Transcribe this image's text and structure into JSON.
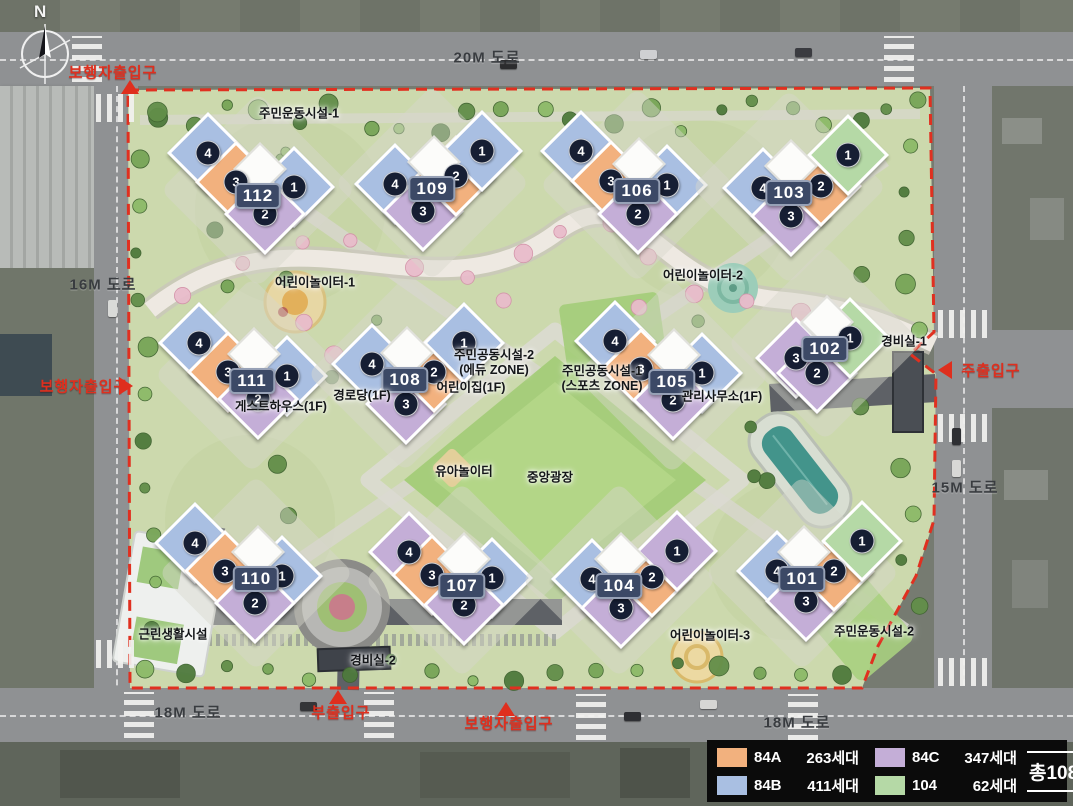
{
  "colors": {
    "84A": "#f2b17e",
    "84B": "#a9bfe2",
    "84C": "#c4aed7",
    "104": "#b5d9a6",
    "accent_red": "#df2f1e",
    "badge_bg": "#3c4966",
    "circle_bg": "#161e33"
  },
  "compass": {
    "north_label": "N"
  },
  "roads": [
    {
      "label": "20M 도로",
      "x": 487,
      "y": 57
    },
    {
      "label": "16M 도로",
      "x": 103,
      "y": 284
    },
    {
      "label": "15M 도로",
      "x": 965,
      "y": 487
    },
    {
      "label": "18M 도로",
      "x": 188,
      "y": 712
    },
    {
      "label": "18M 도로",
      "x": 797,
      "y": 722
    }
  ],
  "entrances": [
    {
      "label": "보행자출입구",
      "lx": 113,
      "ly": 72,
      "tx": 130,
      "ty": 87,
      "dir": "up"
    },
    {
      "label": "보행자출입구",
      "lx": 84,
      "ly": 386,
      "tx": 126,
      "ty": 386,
      "dir": "right"
    },
    {
      "label": "주출입구",
      "lx": 991,
      "ly": 370,
      "tx": 945,
      "ty": 370,
      "dir": "left"
    },
    {
      "label": "부출입구",
      "lx": 341,
      "ly": 712,
      "tx": 338,
      "ty": 697,
      "dir": "up"
    },
    {
      "label": "보행자출입구",
      "lx": 509,
      "ly": 723,
      "tx": 506,
      "ty": 709,
      "dir": "up"
    }
  ],
  "facilities": [
    {
      "label": "주민운동시설-1",
      "x": 299,
      "y": 114
    },
    {
      "label": "어린이놀이터-1",
      "x": 315,
      "y": 283
    },
    {
      "label": "어린이놀이터-2",
      "x": 703,
      "y": 276
    },
    {
      "label": "주민공동시설-2\n(에듀 ZONE)",
      "x": 494,
      "y": 363
    },
    {
      "label": "어린이집(1F)",
      "x": 471,
      "y": 388
    },
    {
      "label": "경로당(1F)",
      "x": 362,
      "y": 396
    },
    {
      "label": "게스트하우스(1F)",
      "x": 281,
      "y": 407
    },
    {
      "label": "주민공동시설-1\n(스포츠 ZONE)",
      "x": 602,
      "y": 379
    },
    {
      "label": "관리사무소(1F)",
      "x": 722,
      "y": 397
    },
    {
      "label": "경비실-1",
      "x": 904,
      "y": 342
    },
    {
      "label": "유아놀이터",
      "x": 464,
      "y": 472
    },
    {
      "label": "중앙광장",
      "x": 550,
      "y": 478
    },
    {
      "label": "근린생활시설",
      "x": 173,
      "y": 635
    },
    {
      "label": "경비실-2",
      "x": 373,
      "y": 661
    },
    {
      "label": "어린이놀이터-3",
      "x": 710,
      "y": 636
    },
    {
      "label": "주민운동시설-2",
      "x": 874,
      "y": 632
    }
  ],
  "buildings": [
    {
      "id": "112",
      "x": 258,
      "y": 196,
      "units": [
        {
          "no": "4",
          "type": "84B",
          "x": 208,
          "y": 153
        },
        {
          "no": "3",
          "type": "84A",
          "x": 236,
          "y": 182
        },
        {
          "no": "1",
          "type": "84B",
          "x": 294,
          "y": 187
        },
        {
          "no": "2",
          "type": "84C",
          "x": 265,
          "y": 214
        }
      ]
    },
    {
      "id": "109",
      "x": 432,
      "y": 189,
      "units": [
        {
          "no": "4",
          "type": "84B",
          "x": 395,
          "y": 184
        },
        {
          "no": "3",
          "type": "84C",
          "x": 423,
          "y": 211
        },
        {
          "no": "2",
          "type": "84A",
          "x": 456,
          "y": 176
        },
        {
          "no": "1",
          "type": "84B",
          "x": 482,
          "y": 151
        }
      ]
    },
    {
      "id": "106",
      "x": 637,
      "y": 191,
      "units": [
        {
          "no": "4",
          "type": "84B",
          "x": 581,
          "y": 151
        },
        {
          "no": "3",
          "type": "84A",
          "x": 611,
          "y": 181
        },
        {
          "no": "1",
          "type": "84B",
          "x": 667,
          "y": 185
        },
        {
          "no": "2",
          "type": "84C",
          "x": 638,
          "y": 214
        }
      ]
    },
    {
      "id": "103",
      "x": 789,
      "y": 193,
      "units": [
        {
          "no": "4",
          "type": "84B",
          "x": 763,
          "y": 188
        },
        {
          "no": "3",
          "type": "84C",
          "x": 791,
          "y": 216
        },
        {
          "no": "2",
          "type": "84A",
          "x": 821,
          "y": 186
        },
        {
          "no": "1",
          "type": "104",
          "x": 848,
          "y": 155
        }
      ]
    },
    {
      "id": "111",
      "x": 252,
      "y": 381,
      "units": [
        {
          "no": "4",
          "type": "84B",
          "x": 199,
          "y": 343
        },
        {
          "no": "3",
          "type": "84A",
          "x": 228,
          "y": 372
        },
        {
          "no": "1",
          "type": "84B",
          "x": 287,
          "y": 376
        },
        {
          "no": "2",
          "type": "84C",
          "x": 258,
          "y": 399
        }
      ]
    },
    {
      "id": "108",
      "x": 405,
      "y": 380,
      "units": [
        {
          "no": "4",
          "type": "84B",
          "x": 372,
          "y": 364
        },
        {
          "no": "3",
          "type": "84C",
          "x": 406,
          "y": 404
        },
        {
          "no": "2",
          "type": "84A",
          "x": 434,
          "y": 372
        },
        {
          "no": "1",
          "type": "84B",
          "x": 464,
          "y": 343
        }
      ]
    },
    {
      "id": "105",
      "x": 672,
      "y": 382,
      "units": [
        {
          "no": "4",
          "type": "84B",
          "x": 615,
          "y": 341
        },
        {
          "no": "3",
          "type": "84A",
          "x": 641,
          "y": 369
        },
        {
          "no": "1",
          "type": "84B",
          "x": 702,
          "y": 373
        },
        {
          "no": "2",
          "type": "84C",
          "x": 673,
          "y": 400
        }
      ]
    },
    {
      "id": "102",
      "x": 825,
      "y": 349,
      "units": [
        {
          "no": "3",
          "type": "84C",
          "x": 796,
          "y": 358
        },
        {
          "no": "2",
          "type": "84C",
          "x": 817,
          "y": 373
        },
        {
          "no": "1",
          "type": "104",
          "x": 850,
          "y": 338
        }
      ]
    },
    {
      "id": "110",
      "x": 256,
      "y": 579,
      "units": [
        {
          "no": "4",
          "type": "84B",
          "x": 195,
          "y": 543
        },
        {
          "no": "3",
          "type": "84A",
          "x": 225,
          "y": 571
        },
        {
          "no": "1",
          "type": "84B",
          "x": 282,
          "y": 576
        },
        {
          "no": "2",
          "type": "84C",
          "x": 255,
          "y": 603
        }
      ]
    },
    {
      "id": "107",
      "x": 462,
      "y": 586,
      "units": [
        {
          "no": "4",
          "type": "84C",
          "x": 409,
          "y": 552
        },
        {
          "no": "3",
          "type": "84A",
          "x": 432,
          "y": 575
        },
        {
          "no": "1",
          "type": "84B",
          "x": 492,
          "y": 578
        },
        {
          "no": "2",
          "type": "84C",
          "x": 464,
          "y": 605
        }
      ]
    },
    {
      "id": "104",
      "x": 619,
      "y": 586,
      "units": [
        {
          "no": "4",
          "type": "84B",
          "x": 592,
          "y": 579
        },
        {
          "no": "3",
          "type": "84C",
          "x": 621,
          "y": 608
        },
        {
          "no": "2",
          "type": "84A",
          "x": 652,
          "y": 577
        },
        {
          "no": "1",
          "type": "84C",
          "x": 677,
          "y": 551
        }
      ]
    },
    {
      "id": "101",
      "x": 802,
      "y": 579,
      "units": [
        {
          "no": "4",
          "type": "84B",
          "x": 777,
          "y": 571
        },
        {
          "no": "3",
          "type": "84C",
          "x": 806,
          "y": 601
        },
        {
          "no": "2",
          "type": "84A",
          "x": 834,
          "y": 571
        },
        {
          "no": "1",
          "type": "104",
          "x": 862,
          "y": 541
        }
      ]
    }
  ],
  "legend": {
    "items": [
      {
        "label": "84A",
        "count": "263세대",
        "type": "84A"
      },
      {
        "label": "84C",
        "count": "347세대",
        "type": "84C"
      },
      {
        "label": "84B",
        "count": "411세대",
        "type": "84B"
      },
      {
        "label": "104",
        "count": "62세대",
        "type": "104"
      }
    ],
    "total": "총1083세대"
  }
}
